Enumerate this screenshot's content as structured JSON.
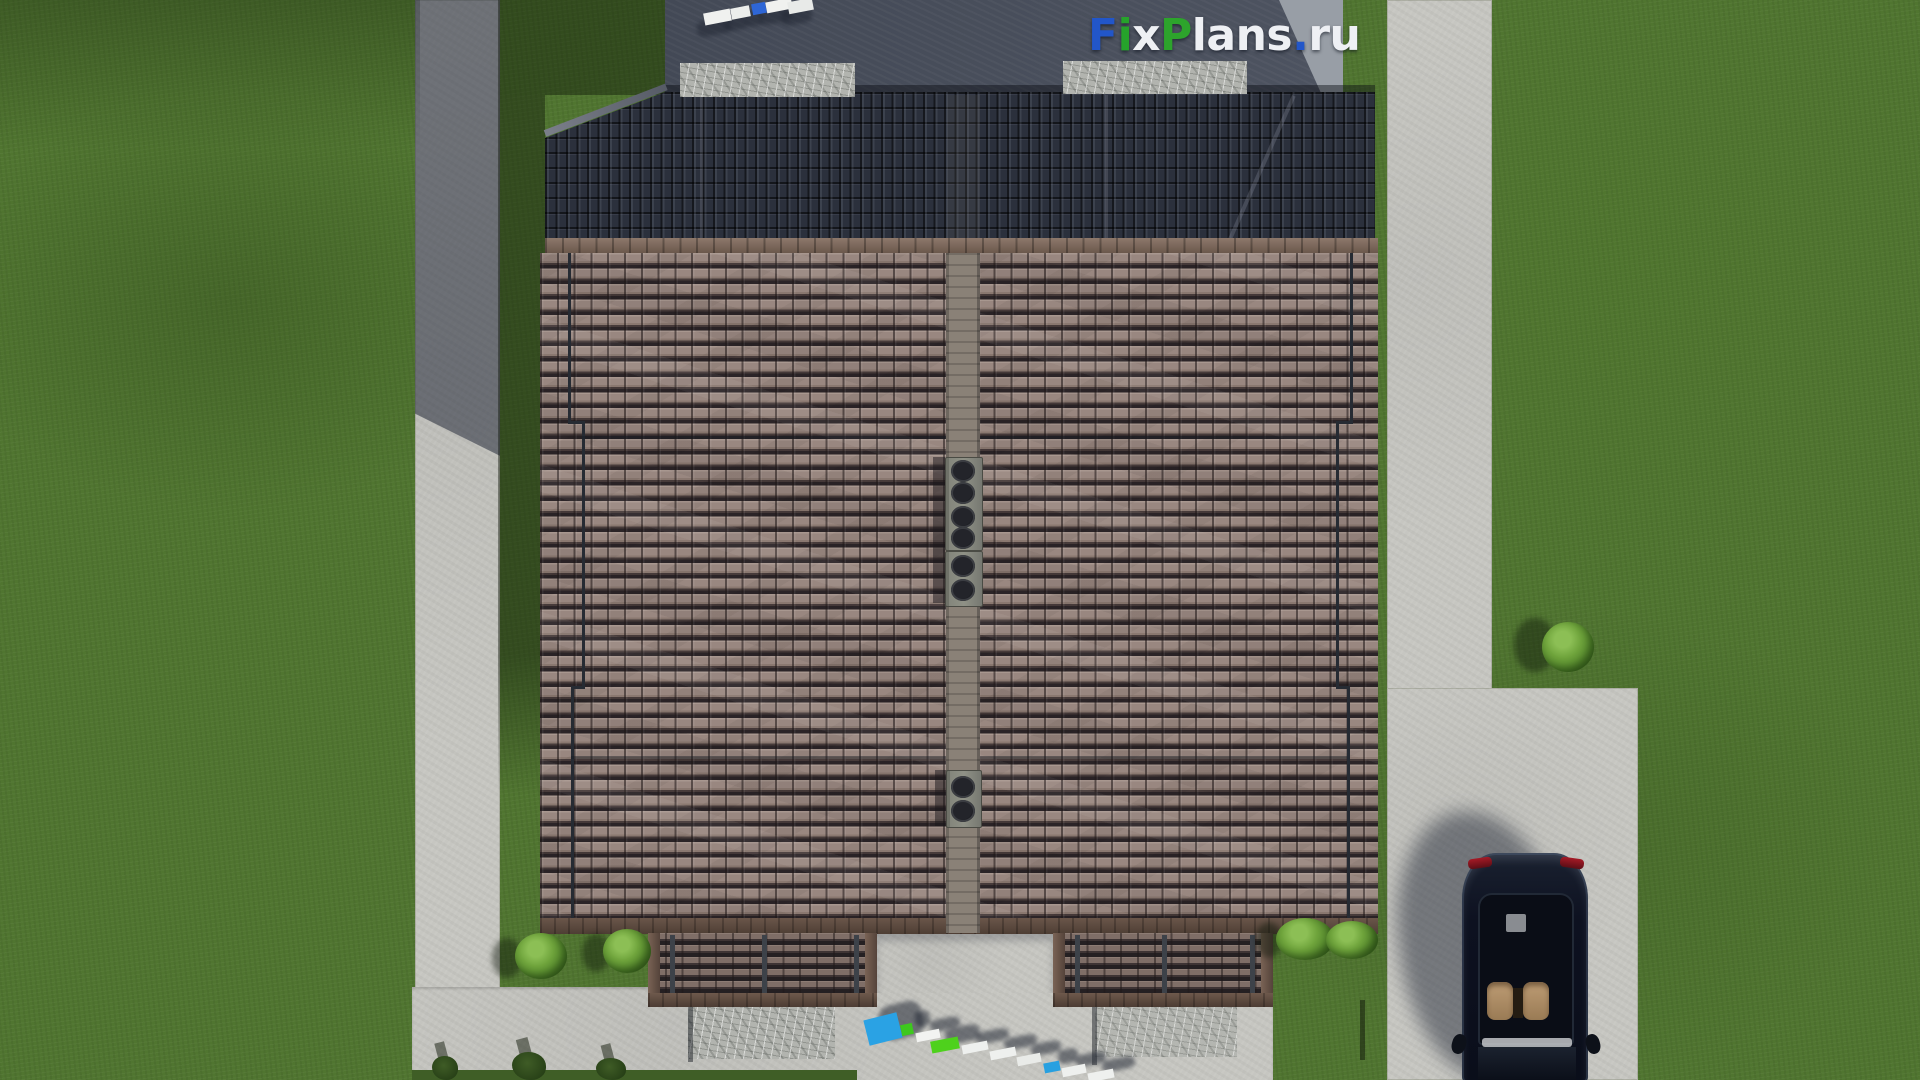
{
  "watermark": {
    "text": "FixPlans.ru",
    "segments": [
      {
        "text": "F",
        "color": "#2256c9"
      },
      {
        "text": "i",
        "color": "#26a32b"
      },
      {
        "text": "x",
        "color": "#eef0f4"
      },
      {
        "text": "P",
        "color": "#2da42c"
      },
      {
        "text": "lans",
        "color": "#eef0f4"
      },
      {
        "text": ".",
        "color": "#2256c9"
      },
      {
        "text": "ru",
        "color": "#eef0f4"
      }
    ]
  },
  "palette": {
    "grass": "#507530",
    "grass_shadowed": "#3a5722",
    "concrete_lit": "#c6c6c1",
    "concrete_shadow": "#4d5360",
    "roof_tile_lit": "#94827a",
    "roof_tile_dark_gap": "#2b2427",
    "roof_back_slope": "#2b303c",
    "fascia_brown": "#6a564a",
    "ridge_strip": "#8a8177",
    "chimney_concrete": "#84867c",
    "granite": "#b2b4af",
    "car_body": "#0d1120",
    "car_seats": "#b29068",
    "bush_green": "#6fa43c",
    "accent_blue": "#2aa2e4",
    "accent_green": "#3ec81e"
  },
  "objects": {
    "terrace_furniture": {
      "shadow": {
        "dx": -7,
        "dy": 8
      },
      "items": [
        {
          "x": 704,
          "y": 11,
          "w": 27,
          "h": 12,
          "c": "#f0f1ef",
          "rot": -11
        },
        {
          "x": 731,
          "y": 7,
          "w": 19,
          "h": 11,
          "c": "#eceeec",
          "rot": -11
        },
        {
          "x": 752,
          "y": 3,
          "w": 14,
          "h": 11,
          "c": "#2e66d6",
          "rot": -11
        },
        {
          "x": 766,
          "y": 0,
          "w": 26,
          "h": 11,
          "c": "#f0f1ef",
          "rot": -11
        },
        {
          "x": 788,
          "y": 0,
          "w": 25,
          "h": 12,
          "c": "#e8eae8",
          "rot": -11
        }
      ]
    },
    "walkway_items": {
      "shadow": {
        "dx": 14,
        "dy": -13
      },
      "items": [
        {
          "x": 866,
          "y": 1016,
          "w": 34,
          "h": 26,
          "c": "#2aa2e4",
          "rot": -14
        },
        {
          "x": 901,
          "y": 1024,
          "w": 12,
          "h": 11,
          "c": "#3ec81e",
          "rot": -12
        },
        {
          "x": 916,
          "y": 1031,
          "w": 24,
          "h": 9,
          "c": "#f2f3f1",
          "rot": -11
        },
        {
          "x": 931,
          "y": 1039,
          "w": 28,
          "h": 12,
          "c": "#4ed11c",
          "rot": -11
        },
        {
          "x": 962,
          "y": 1043,
          "w": 26,
          "h": 9,
          "c": "#eef0ee",
          "rot": -11
        },
        {
          "x": 990,
          "y": 1049,
          "w": 26,
          "h": 9,
          "c": "#eef0ee",
          "rot": -11
        },
        {
          "x": 1017,
          "y": 1055,
          "w": 24,
          "h": 9,
          "c": "#e9ebe8",
          "rot": -11
        },
        {
          "x": 1044,
          "y": 1062,
          "w": 16,
          "h": 10,
          "c": "#28a0e0",
          "rot": -11
        },
        {
          "x": 1062,
          "y": 1066,
          "w": 24,
          "h": 9,
          "c": "#eef0ee",
          "rot": -11
        },
        {
          "x": 1088,
          "y": 1071,
          "w": 26,
          "h": 9,
          "c": "#eef0ee",
          "rot": -11
        }
      ]
    },
    "chimneys": [
      {
        "x": 945,
        "y": 457,
        "w": 36,
        "h": 92,
        "vents": [
          2,
          24,
          48,
          69
        ]
      },
      {
        "x": 945,
        "y": 551,
        "w": 36,
        "h": 54,
        "vents": [
          3,
          27
        ]
      },
      {
        "x": 946,
        "y": 770,
        "w": 34,
        "h": 56,
        "vents": [
          5,
          29
        ]
      }
    ],
    "bushes": [
      {
        "x": 515,
        "y": 933,
        "w": 52,
        "h": 46,
        "dark": false,
        "sx": 492,
        "sy": 938,
        "sw": 30,
        "sh": 40
      },
      {
        "x": 603,
        "y": 929,
        "w": 48,
        "h": 44,
        "dark": false,
        "sx": 582,
        "sy": 934,
        "sw": 28,
        "sh": 38
      },
      {
        "x": 1276,
        "y": 918,
        "w": 58,
        "h": 42,
        "dark": false,
        "sx": 1256,
        "sy": 922,
        "sw": 26,
        "sh": 36
      },
      {
        "x": 1326,
        "y": 921,
        "w": 52,
        "h": 38,
        "dark": false
      },
      {
        "x": 1542,
        "y": 622,
        "w": 52,
        "h": 50,
        "dark": false,
        "sx": 1514,
        "sy": 618,
        "sw": 42,
        "sh": 54
      },
      {
        "x": 432,
        "y": 1056,
        "w": 26,
        "h": 24,
        "dark": true
      },
      {
        "x": 512,
        "y": 1052,
        "w": 34,
        "h": 28,
        "dark": true
      },
      {
        "x": 596,
        "y": 1058,
        "w": 30,
        "h": 22,
        "dark": true
      }
    ]
  }
}
